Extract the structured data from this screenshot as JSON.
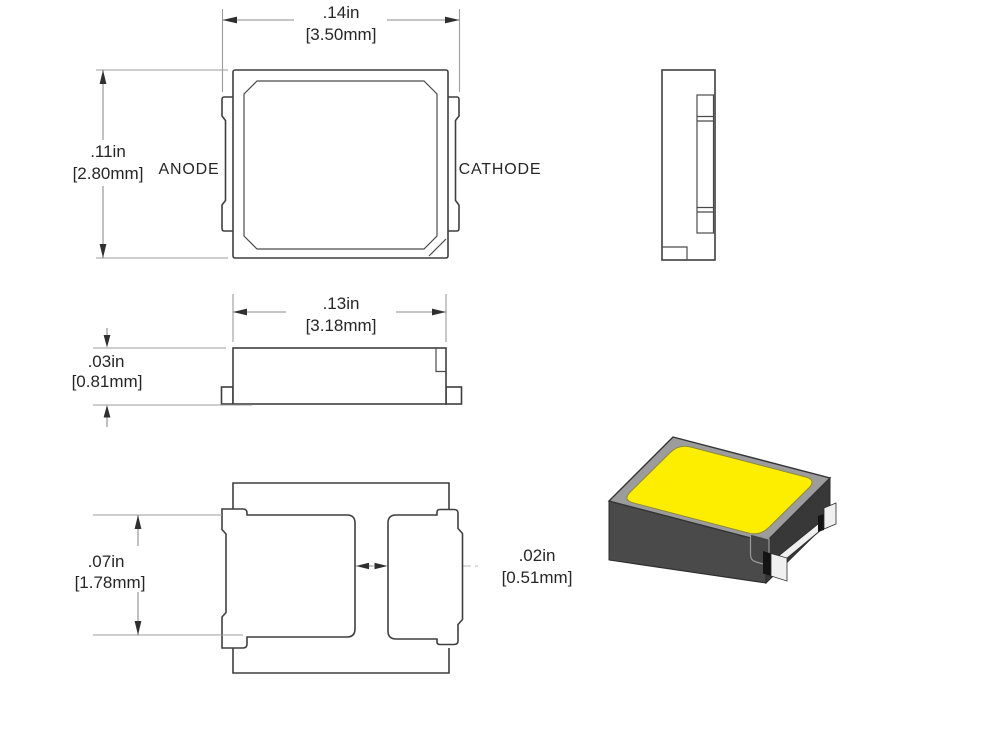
{
  "views": {
    "top": {
      "anode_label": "ANODE",
      "cathode_label": "CATHODE",
      "width": {
        "in": ".14in",
        "mm": "[3.50mm]"
      },
      "height": {
        "in": ".11in",
        "mm": "[2.80mm]"
      }
    },
    "side": {
      "width": {
        "in": ".13in",
        "mm": "[3.18mm]"
      },
      "thickness": {
        "in": ".03in",
        "mm": "[0.81mm]"
      }
    },
    "bottom": {
      "pad_height": {
        "in": ".07in",
        "mm": "[1.78mm]"
      },
      "pad_gap": {
        "in": ".02in",
        "mm": "[0.51mm]"
      }
    }
  },
  "colors": {
    "line": "#3f3f3f",
    "dim_line": "#8b8b8b",
    "text": "#262626",
    "led_top_yellow": "#fdee00",
    "led_body": "#4a4a4a",
    "led_body_dark": "#383838",
    "led_bevel": "#9c9c9c",
    "metal_contact": "#f0f0f0",
    "background": "#ffffff"
  }
}
